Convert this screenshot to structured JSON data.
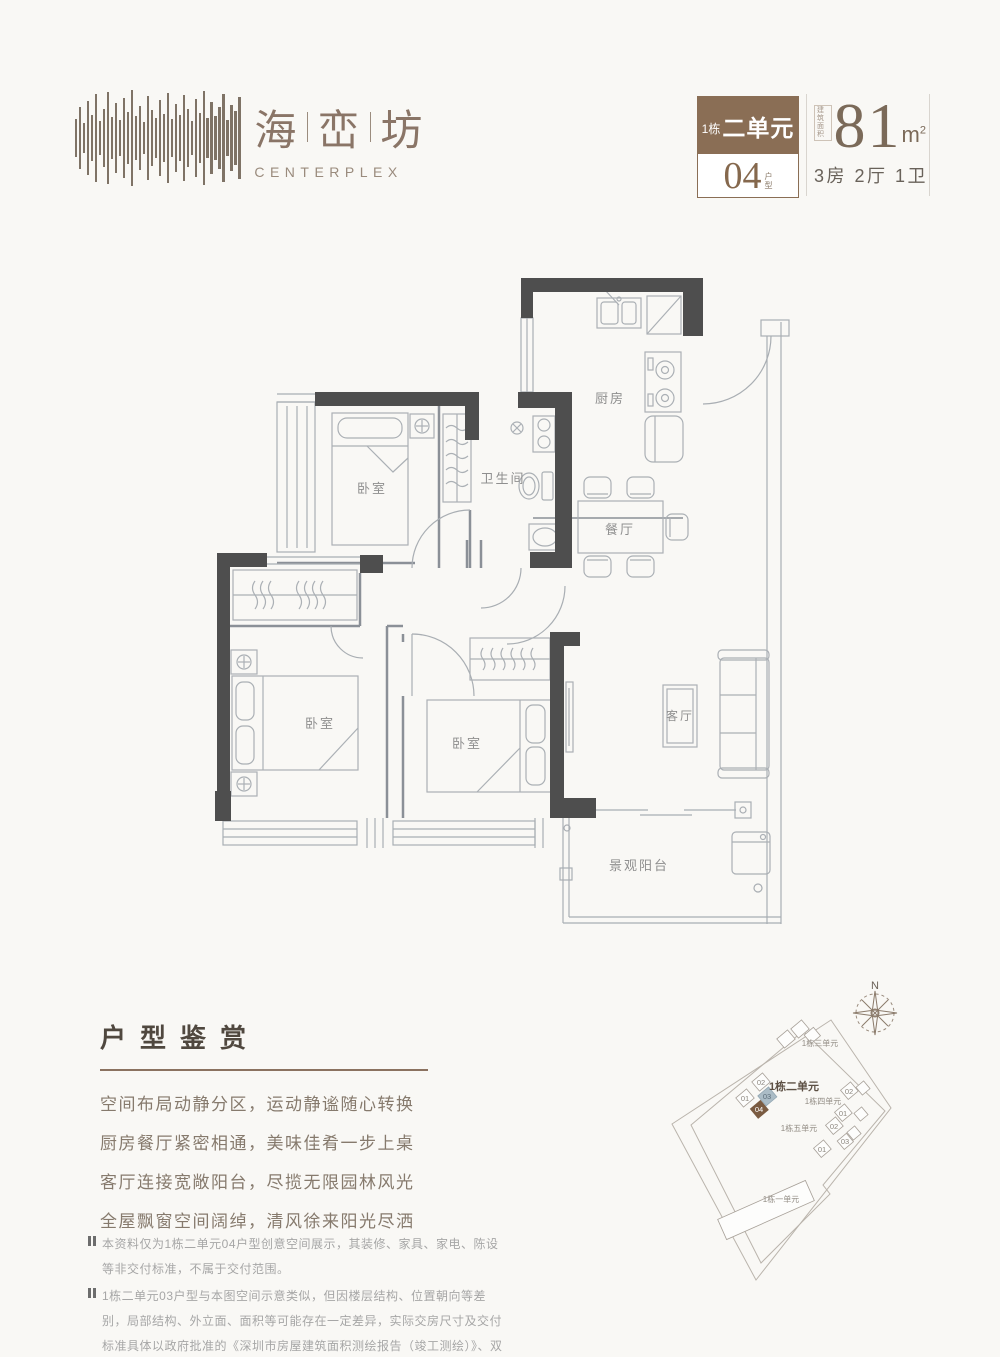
{
  "header": {
    "brand": {
      "chars": [
        "海",
        "峦",
        "坊"
      ],
      "latin": "CENTERPLEX"
    },
    "badge": {
      "building": "1栋",
      "unit": "二单元",
      "type_no": "04",
      "type_chars": [
        "户",
        "型"
      ]
    },
    "area": {
      "stamp": [
        "建筑",
        "面积"
      ],
      "value": "81",
      "unit_base": "m",
      "unit_sup": "2",
      "rooms": "3房 2厅 1卫"
    }
  },
  "floorplan": {
    "labels": {
      "kitchen": "厨房",
      "bath": "卫生间",
      "bedroom": "卧室",
      "dining": "餐厅",
      "living": "客厅",
      "balcony": "景观阳台"
    }
  },
  "review": {
    "title": "户型鉴赏",
    "lines": [
      "空间布局动静分区，运动静谧随心转换",
      "厨房餐厅紧密相通，美味佳肴一步上桌",
      "客厅连接宽敞阳台，尽揽无限园林风光",
      "全屋飘窗空间阔绰，清风徐来阳光尽洒"
    ]
  },
  "notes": [
    "本资料仅为1栋二单元04户型创意空间展示，其装修、家具、家电、陈设等非交付标准，不属于交付范围。",
    "1栋二单元03户型与本图空间示意类似，但因楼层结构、位置朝向等差别，局部结构、外立面、面积等可能存在一定差异，实际交房尺寸及交付标准具体以政府批准的《深圳市房屋建筑面积测绘报告（竣工测绘）》、双方签订的《深圳市商品房买卖合同》及相关协议为准。"
  ],
  "sitemap": {
    "north": "N",
    "labels": {
      "b1": "1栋一单元",
      "b2": "1栋二单元",
      "b3": "1栋三单元",
      "b4": "1栋四单元",
      "b5": "1栋五单元"
    },
    "unit_numbers": {
      "n01": "01",
      "n02": "02",
      "n03": "03",
      "n04": "04"
    },
    "colors": {
      "highlight_unit": "#7a5b41",
      "sibling_unit": "#abbcc6"
    }
  }
}
